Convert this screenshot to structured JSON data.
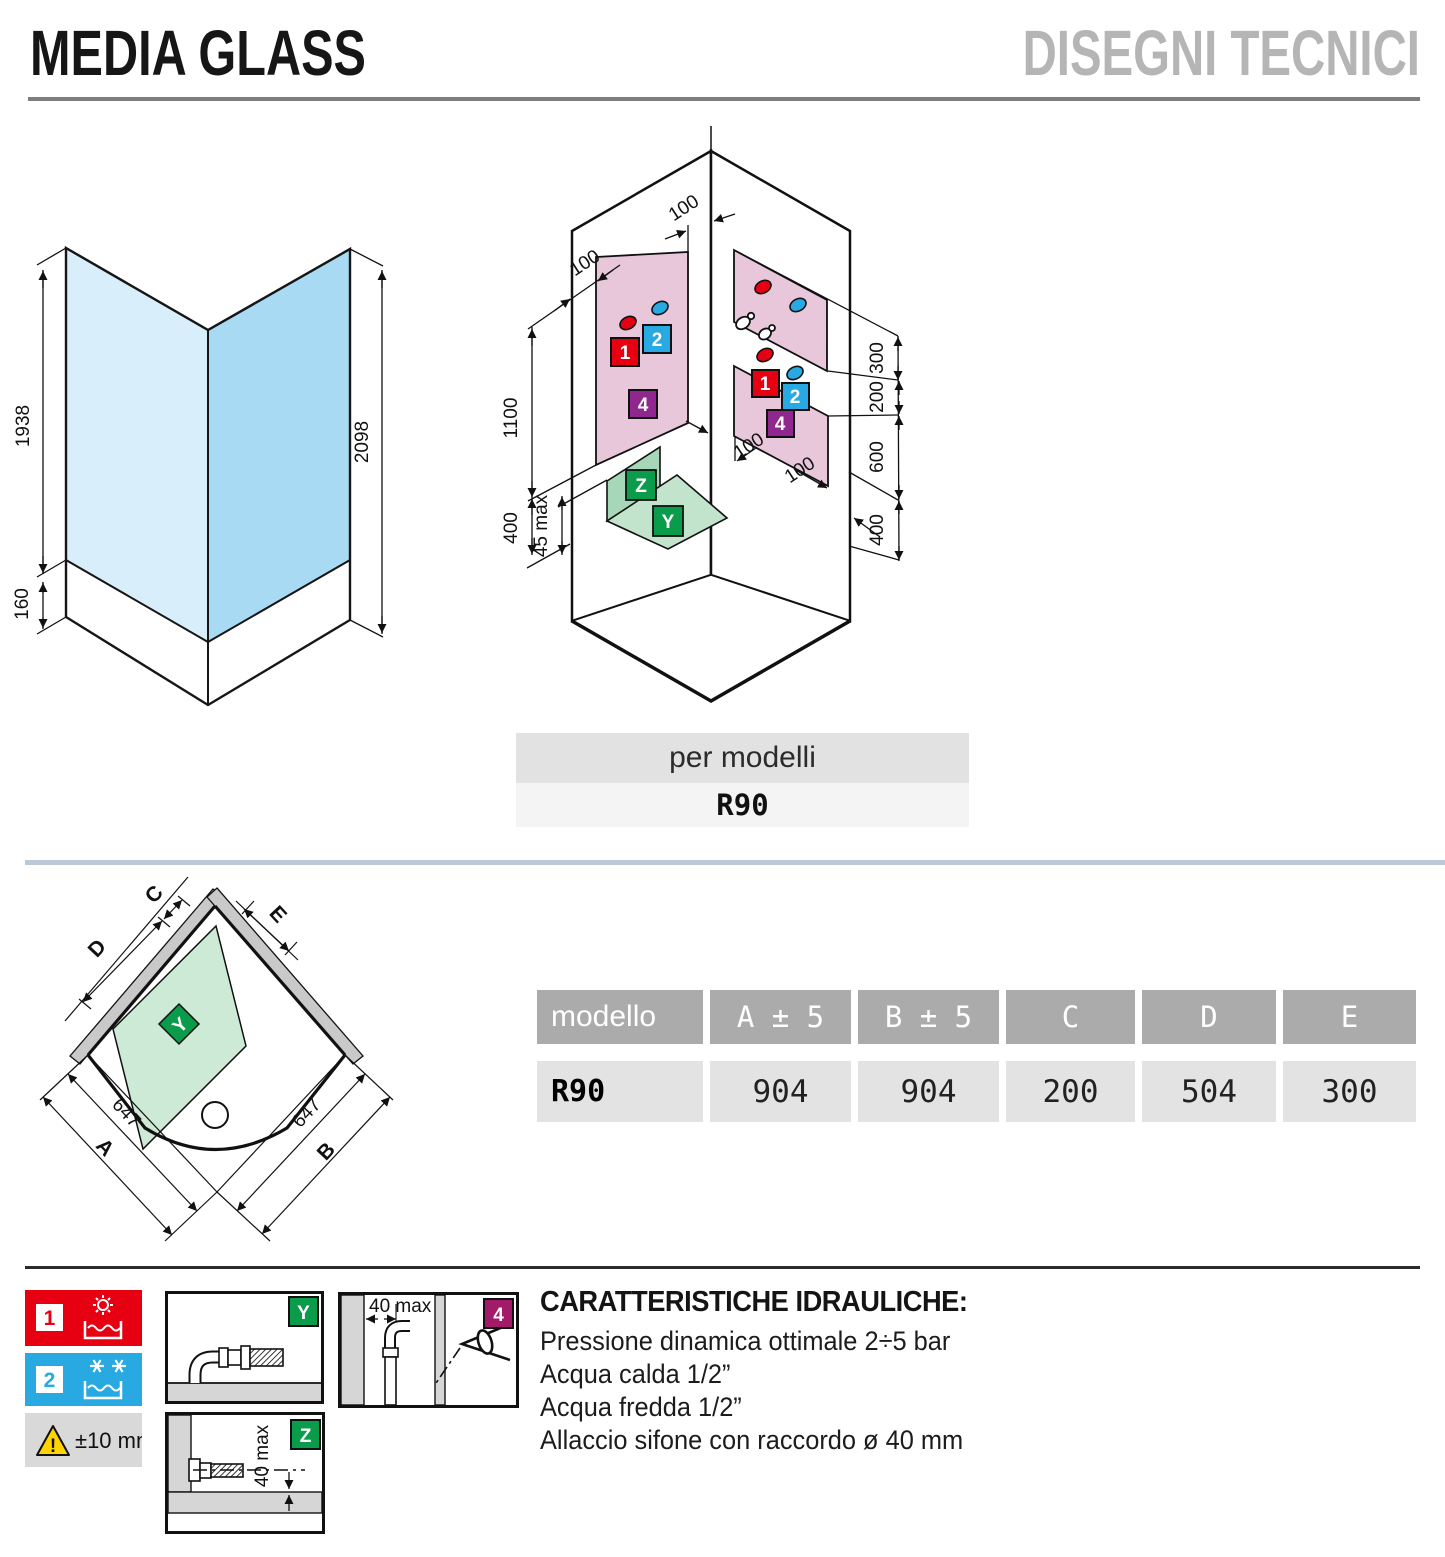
{
  "header": {
    "title": "MEDIA GLASS",
    "subtitle": "DISEGNI TECNICI"
  },
  "front_view": {
    "glass_height": "1938",
    "base_height": "160",
    "total_height": "2098"
  },
  "corner_view": {
    "top_corner_offset": "100",
    "wall_edge_offset": "100",
    "panel_height": "1100",
    "base_offset_left": "400",
    "tray_height": "45 max",
    "right_offsets": {
      "r1": "300",
      "r2": "200",
      "r3": "600",
      "r4": "400"
    },
    "floor_offset_1": "100",
    "floor_offset_2": "100",
    "markers": {
      "hot": "1",
      "cold": "2",
      "inspection": "4",
      "drain_wall": "Z",
      "drain_floor": "Y"
    }
  },
  "models": {
    "label": "per modelli",
    "value": "R90"
  },
  "plan_view": {
    "dim_a": "A",
    "dim_b": "B",
    "dim_c": "C",
    "dim_d": "D",
    "dim_e": "E",
    "radius_left": "647",
    "radius_right": "647",
    "floor_marker": "Y"
  },
  "table": {
    "headers": [
      "modello",
      "A ± 5",
      "B ± 5",
      "C",
      "D",
      "E"
    ],
    "row": {
      "model": "R90",
      "a": "904",
      "b": "904",
      "c": "200",
      "d": "504",
      "e": "300"
    }
  },
  "legend": {
    "hot_number": "1",
    "cold_number": "2",
    "tolerance": "±10 mm",
    "floor_drain": "Y",
    "wall_drain": "Z",
    "wall_drain_dim": "40 max",
    "niche_dim": "40 max",
    "inspection": "4"
  },
  "hydraulics": {
    "title": "CARATTERISTICHE IDRAULICHE:",
    "lines": [
      "Pressione dinamica ottimale 2÷5 bar",
      "Acqua calda 1/2”",
      "Acqua fredda 1/2”",
      "Allaccio sifone con raccordo ø 40 mm"
    ]
  },
  "colors": {
    "accent_red": "#e60012",
    "accent_blue": "#29a9e1",
    "accent_purple": "#90278e",
    "accent_magenta": "#a21a68",
    "accent_green": "#0a9b4b",
    "panel_pink": "#e8c7db",
    "glass_light": "#d9eefb",
    "glass_dark": "#a9daf3",
    "warning_yellow": "#ffd400"
  }
}
